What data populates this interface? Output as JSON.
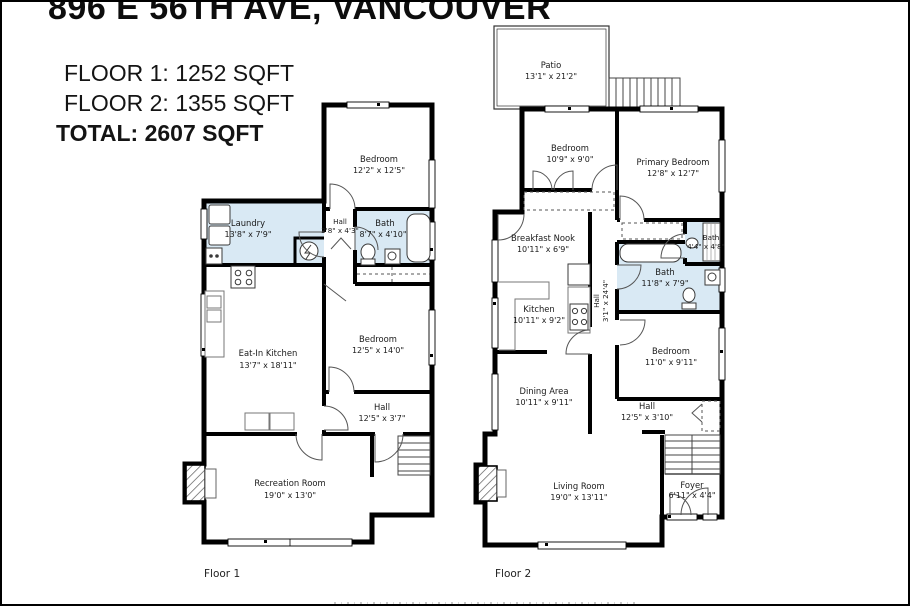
{
  "header": {
    "title": "896 E 56TH AVE, VANCOUVER",
    "floor1_area": "FLOOR 1: 1252 SQFT",
    "floor2_area": "FLOOR 2: 1355 SQFT",
    "total_area": "TOTAL: 2607 SQFT"
  },
  "colors": {
    "wall": "#000000",
    "wet_room_fill": "#d9e9f4",
    "background": "#ffffff"
  },
  "floor1": {
    "label": "Floor 1",
    "rooms": {
      "bedroom1": {
        "name": "Bedroom",
        "dims": "12'2\" x 12'5\""
      },
      "laundry": {
        "name": "Laundry",
        "dims": "13'8\" x 7'9\""
      },
      "hall1": {
        "name": "Hall",
        "dims": "3'8\" x 4'3\""
      },
      "bath": {
        "name": "Bath",
        "dims": "8'7\" x 4'10\""
      },
      "kitchen": {
        "name": "Eat-In Kitchen",
        "dims": "13'7\" x 18'11\""
      },
      "bedroom2": {
        "name": "Bedroom",
        "dims": "12'5\" x 14'0\""
      },
      "hall2": {
        "name": "Hall",
        "dims": "12'5\" x 3'7\""
      },
      "recreation": {
        "name": "Recreation Room",
        "dims": "19'0\" x 13'0\""
      }
    }
  },
  "floor2": {
    "label": "Floor 2",
    "rooms": {
      "patio": {
        "name": "Patio",
        "dims": "13'1\" x 21'2\""
      },
      "bedroom1": {
        "name": "Bedroom",
        "dims": "10'9\" x 9'0\""
      },
      "primary": {
        "name": "Primary Bedroom",
        "dims": "12'8\" x 12'7\""
      },
      "nook": {
        "name": "Breakfast Nook",
        "dims": "10'11\" x 6'9\""
      },
      "bath_small": {
        "name": "Bath",
        "dims": "4'4\" x 4'8\""
      },
      "bath": {
        "name": "Bath",
        "dims": "11'8\" x 7'9\""
      },
      "kitchen": {
        "name": "Kitchen",
        "dims": "10'11\" x 9'2\""
      },
      "hall_v": {
        "name": "Hall",
        "dims": "3'1\" x 24'4\""
      },
      "bedroom2": {
        "name": "Bedroom",
        "dims": "11'0\" x 9'11\""
      },
      "dining": {
        "name": "Dining Area",
        "dims": "10'11\" x 9'11\""
      },
      "hall_h": {
        "name": "Hall",
        "dims": "12'5\" x 3'10\""
      },
      "living": {
        "name": "Living Room",
        "dims": "19'0\" x 13'11\""
      },
      "foyer": {
        "name": "Foyer",
        "dims": "6'11\" x 4'4\""
      }
    }
  }
}
